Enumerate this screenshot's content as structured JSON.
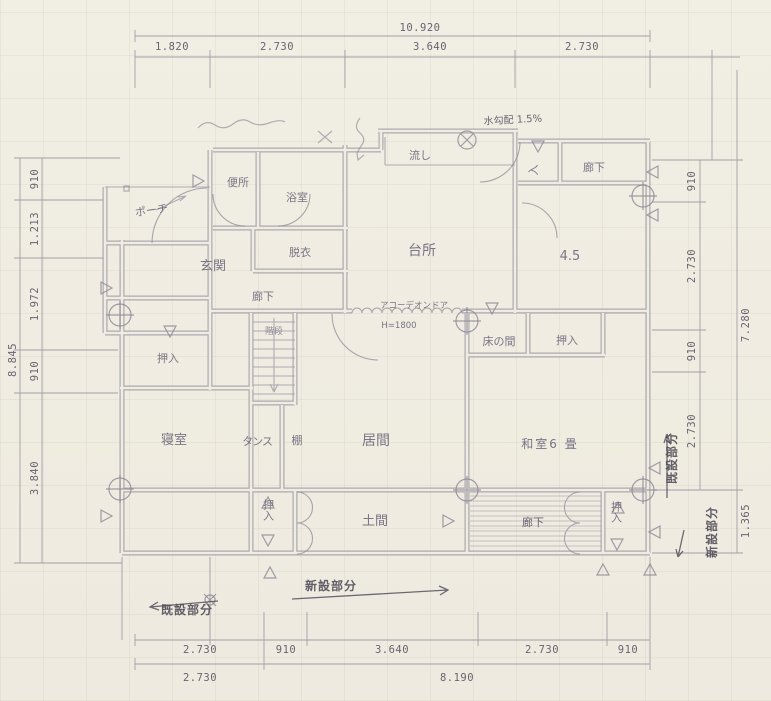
{
  "colors": {
    "paper": "#f0ede2",
    "pencil_line": "#8f8b98",
    "label_text": "#6f6b7e",
    "annotation_text": "#4e4b57"
  },
  "dims": {
    "top_total": "10.920",
    "top": [
      "1.820",
      "2.730",
      "3.640",
      "2.730"
    ],
    "left_total": "8.845",
    "left": [
      "910",
      "1.213",
      "1.972",
      "910",
      "3.840"
    ],
    "right_total": "7.280",
    "right": [
      "910",
      "2.730",
      "910",
      "2.730"
    ],
    "right_extra": "1.365",
    "bottom": [
      "2.730",
      "910",
      "3.640",
      "2.730",
      "910"
    ],
    "bottom_sub": [
      "2.730",
      "8.190"
    ]
  },
  "rooms": {
    "porch": "ポーチ",
    "genkan": "玄関",
    "toilet": "便所",
    "bath": "浴室",
    "datsui": "脱衣",
    "sink": "流し",
    "entry": "入",
    "rouka_top": "廊下",
    "kitchen": "台所",
    "yojohan": "4.5",
    "rouka_center": "廊下",
    "kaidan": "階段",
    "oshiire_left": "押入",
    "tokonoma": "床の間",
    "oshiire_toko": "押入",
    "shinshitsu": "寝室",
    "tansu": "タンス",
    "tana": "棚",
    "ima": "居間",
    "washitsu": "和室6 畳",
    "oshiire_bottom": "押入",
    "doma": "土間",
    "rouka_bottom": "廊下",
    "oshiire_br": "押入"
  },
  "notes": {
    "accordion": "アコーデオンドア",
    "accordion_h": "H=1800",
    "slope": "水勾配 1.5%",
    "new_bottom": "新設部分",
    "existing_bottom": "既設部分",
    "existing_right": "既設部分",
    "new_right": "新設部分"
  }
}
